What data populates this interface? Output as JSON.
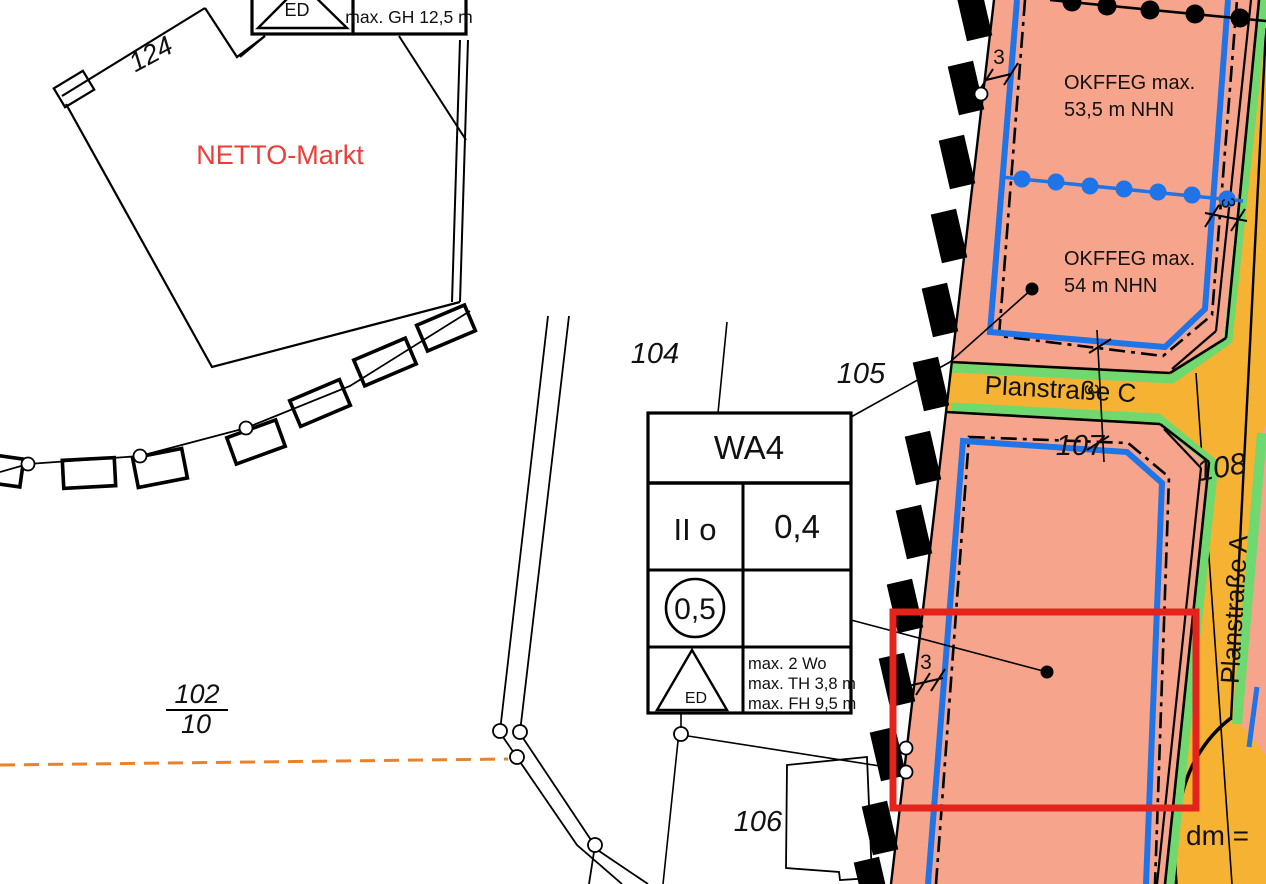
{
  "labels": {
    "netto": "NETTO-Markt",
    "parcel_124": "124",
    "parcel_104": "104",
    "parcel_105": "105",
    "parcel_106": "106",
    "parcel_107": "107",
    "parcel_108": "108",
    "parcel_102_num": "102",
    "parcel_102_den": "10",
    "street_c": "Planstraße C",
    "street_a": "Planstraße A",
    "dm": "dm =",
    "okffeg_upper_line1": "OKFFEG max.",
    "okffeg_upper_line2": "53,5 m NHN",
    "okffeg_lower_line1": "OKFFEG max.",
    "okffeg_lower_line2": "54 m NHN"
  },
  "dims": {
    "d1": "3",
    "d2": "3",
    "d3": "3",
    "d4": "3"
  },
  "schablone_wa4": {
    "zone": "WA4",
    "storeys": "II o",
    "grz": "0,4",
    "gfz": "0,5",
    "roof": "ED",
    "note1": "max. 2 Wo",
    "note2": "max. TH 3,8 m",
    "note3": "max. FH 9,5 m"
  },
  "schablone_top": {
    "roof": "ED",
    "note": "max. GH 12,5 m"
  },
  "colors": {
    "salmon": "#F6A48B",
    "street_yellow": "#F5B233",
    "green_strip": "#6FD96F",
    "blue_line": "#1F74E8",
    "red_box": "#E3241C",
    "red_text": "#F03C36",
    "orange_dash": "#E8832C",
    "ink": "#000000"
  }
}
